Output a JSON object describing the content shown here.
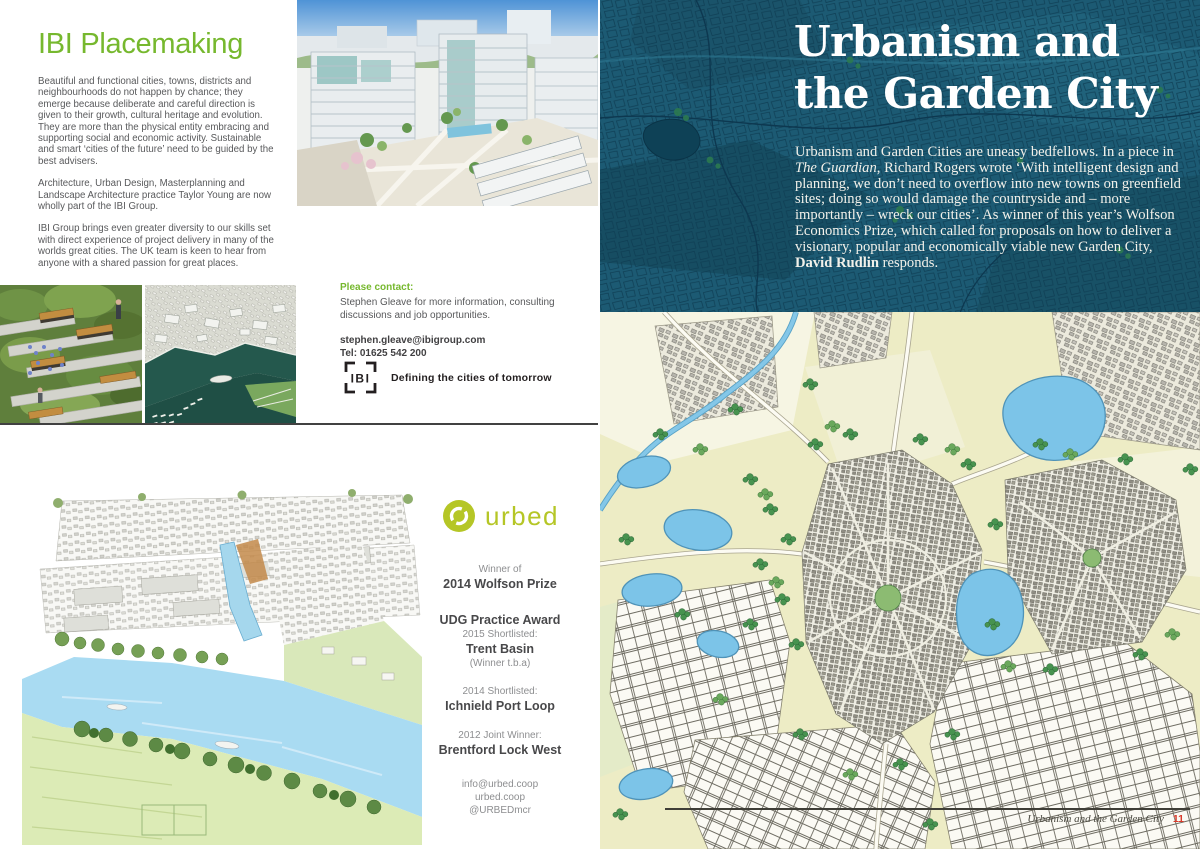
{
  "colors": {
    "accent_green": "#76B82E",
    "urbed_green": "#B5C626",
    "teal_map_bg": "#1C5A73",
    "body_gray": "#58595B",
    "dark_text": "#414042",
    "headline_white": "#FFFFFF",
    "page_number_red": "#D93A2B"
  },
  "icons": {
    "ibi_logo": "ibi-bracket-mark-icon",
    "urbed_logo": "urbed-loop-icon"
  },
  "left": {
    "title": "IBI Placemaking",
    "paragraphs": [
      "Beautiful and functional cities, towns, districts and neighbourhoods do not happen by chance; they emerge because deliberate and careful direction is given to their growth, cultural heritage and evolution. They are more than the physical entity embracing and supporting social and economic activity. Sustainable and smart ‘cities of the future’ need to be guided by the best advisers.",
      "Architecture, Urban Design, Masterplanning and Landscape Architecture practice Taylor Young are now wholly part of the IBI Group.",
      "IBI Group brings even greater diversity to our skills set with direct experience of project delivery in many of the worlds great cities. The UK team is keen to hear from anyone with a shared passion for great places."
    ],
    "contact": {
      "heading": "Please contact:",
      "body": "Stephen Gleave for more information, consulting discussions and job opportunities.",
      "email": "stephen.gleave@ibigroup.com",
      "tel": "Tel: 01625 542 200"
    },
    "ibi": {
      "logo_text": "IBI",
      "tagline": "Defining the cities of tomorrow"
    },
    "urbed": {
      "name": "urbed",
      "winner_label": "Winner of",
      "winner_title": "2014 Wolfson Prize",
      "udg_title": "UDG Practice Award",
      "y2015_label": "2015 Shortlisted:",
      "y2015_title": "Trent Basin",
      "y2015_note": "(Winner t.b.a)",
      "y2014_label": "2014 Shortlisted:",
      "y2014_title": "Ichnield Port Loop",
      "y2012_label": "2012 Joint Winner:",
      "y2012_title": "Brentford Lock West",
      "email": "info@urbed.coop",
      "website": "urbed.coop",
      "twitter": "@URBEDmcr"
    }
  },
  "right": {
    "title_line1": "Urbanism and",
    "title_line2": "the Garden City",
    "intro": {
      "s1": "Urbanism and Garden Cities are uneasy bedfellows. In a piece in ",
      "s2": "The Guardian",
      "s3": ", Richard Rogers wrote ‘With intelligent design and planning, we don’t need to overflow into new towns on greenfield sites; doing so would damage the countryside and – more importantly – wreck our cities’. As winner of this year’s Wolfson Economics Prize, which called for proposals on how to deliver a visionary, popular and economically viable new Garden City, ",
      "s4": "David Rudlin",
      "s5": " responds."
    },
    "footer": {
      "caption": "Urbanism and the Garden City",
      "page_number": "11"
    }
  }
}
